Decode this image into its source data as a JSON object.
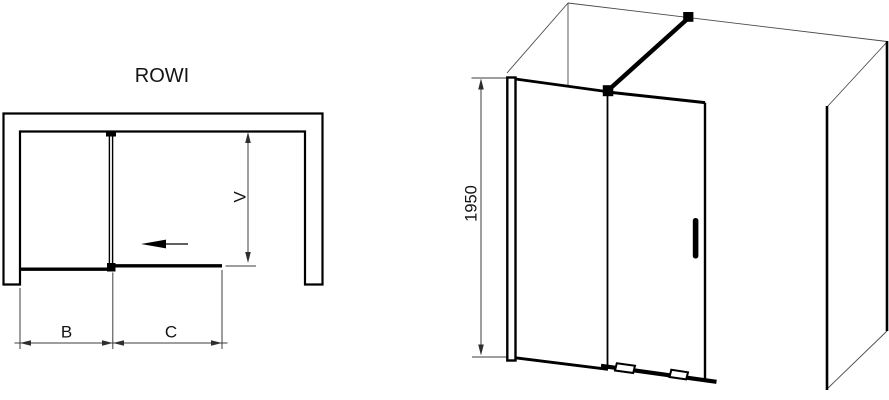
{
  "drawing": {
    "product_name": "ROWI"
  },
  "plan_view": {
    "title": "ROWI",
    "dim_b_label": "B",
    "dim_c_label": "C",
    "dim_v_label": "V"
  },
  "isometric_view": {
    "height_label": "1950"
  },
  "colors": {
    "ink": "#000000",
    "dimension_lines": "#3d3d3d",
    "background": "#ffffff"
  }
}
